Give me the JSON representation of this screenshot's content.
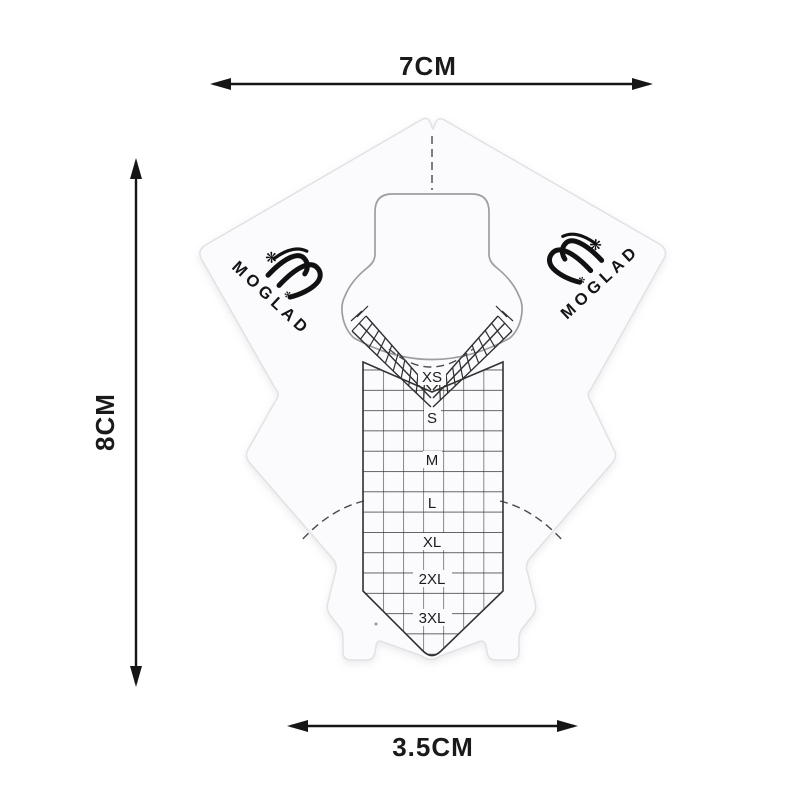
{
  "product": {
    "brand": "MOGLAD",
    "size_labels": [
      "XS",
      "S",
      "M",
      "L",
      "XL",
      "2XL",
      "3XL"
    ],
    "dimensions": {
      "width": "7CM",
      "height": "8CM",
      "tip_width": "3.5CM"
    },
    "icons": {
      "flower_large": "❋",
      "flower_small": "✻"
    },
    "colors": {
      "ink": "#1a1a1a",
      "grid_line": "#333333",
      "paper": "#fbfbfd",
      "paper_edge": "#e3e3e7",
      "guide_gray": "#9d9da2"
    }
  }
}
